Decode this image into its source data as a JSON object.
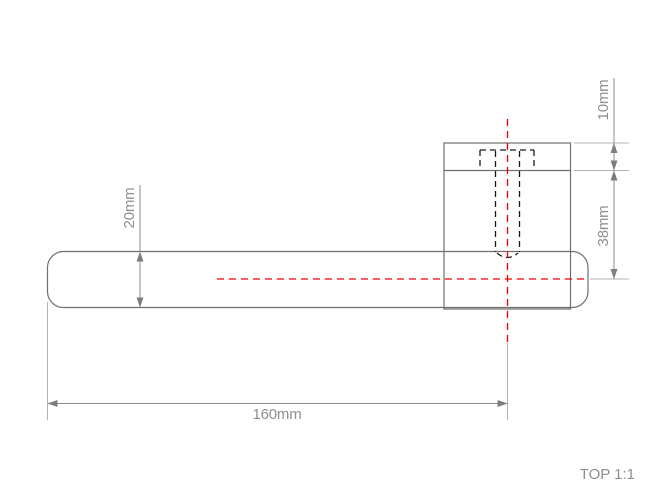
{
  "drawing": {
    "view_label": "TOP 1:1",
    "part": "door-lever-handle-top-view",
    "dimensions": {
      "rose_top_section": {
        "label": "10mm",
        "orientation": "vertical"
      },
      "rose_to_centerline": {
        "label": "38mm",
        "orientation": "vertical"
      },
      "lever_width": {
        "label": "20mm",
        "orientation": "vertical"
      },
      "lever_length": {
        "label": "160mm",
        "orientation": "horizontal"
      }
    },
    "colors": {
      "background": "#ffffff",
      "outline": "#6f6f6f",
      "hidden_line": "#1a1a1a",
      "centerline": "#ee0000",
      "dimension": "#8c8c8c",
      "extension": "#b3b3b3",
      "arrow": "#7d7d7d",
      "text": "#8f8f8f"
    }
  }
}
